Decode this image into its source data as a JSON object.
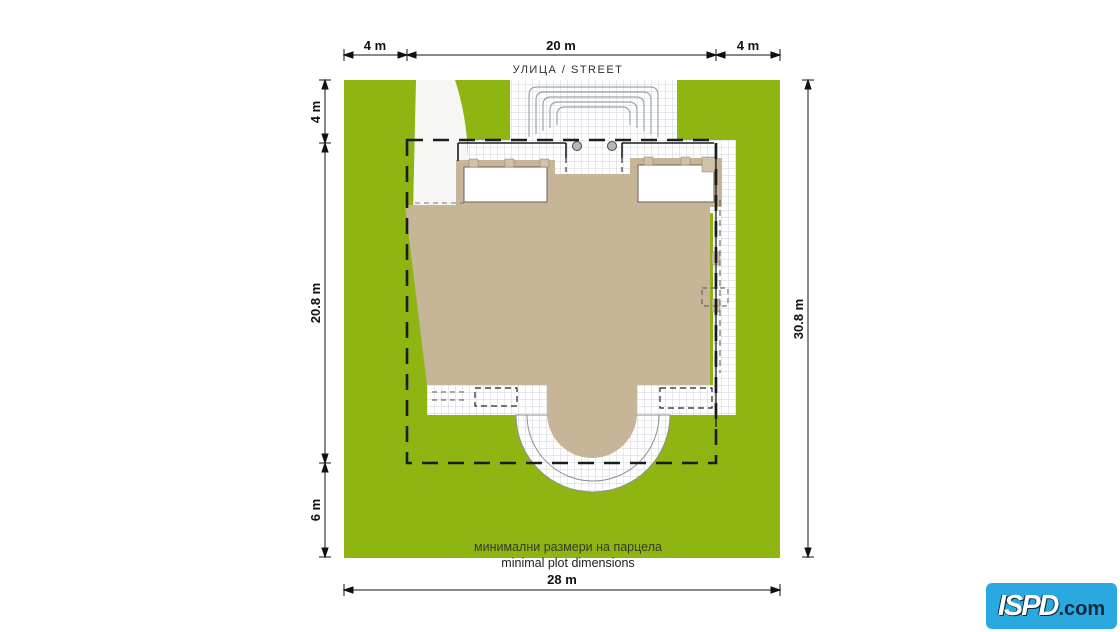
{
  "street_label": "УЛИЦА / STREET",
  "captions": {
    "bg": "минимални размери на парцела",
    "en": "minimal plot dimensions"
  },
  "dimensions": {
    "top": [
      "4 m",
      "20 m",
      "4 m"
    ],
    "left": [
      "4 m",
      "20.8 m",
      "6 m"
    ],
    "right": "30.8 m",
    "bottom": "28 m"
  },
  "logo": {
    "brand": "ISPD",
    "suffix": ".com"
  },
  "colors": {
    "plot_green": "#8fb513",
    "building_tan": "#c6b596",
    "paving_grid": "#ccd2de",
    "setback_line": "#1c1c1c",
    "logo_blue": "#29a9e0",
    "logo_dark": "#13293f"
  }
}
